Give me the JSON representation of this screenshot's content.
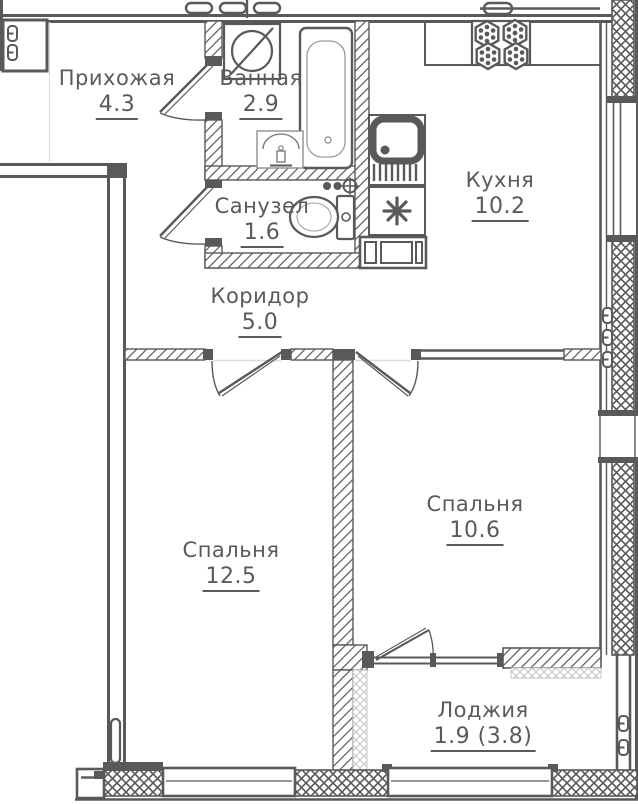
{
  "rooms": {
    "hallway": {
      "label": "Прихожая",
      "area": "4.3"
    },
    "bathroom": {
      "label": "Ванная",
      "area": "2.9"
    },
    "wc": {
      "label": "Санузел",
      "area": "1.6"
    },
    "kitchen": {
      "label": "Кухня",
      "area": "10.2"
    },
    "corridor": {
      "label": "Коридор",
      "area": "5.0"
    },
    "bedroom_main": {
      "label": "Спальня",
      "area": "12.5"
    },
    "bedroom_second": {
      "label": "Спальня",
      "area": "10.6"
    },
    "loggia": {
      "label": "Лоджия",
      "area": "1.9 (3.8)"
    }
  },
  "fixtures": [
    "washing-machine",
    "bathtub",
    "wash-basin",
    "toilet",
    "kitchen-sink",
    "stove-burners",
    "ventilation-shaft",
    "radiator"
  ],
  "colors": {
    "wall": "#58595b",
    "hatch_light": "#c6c6c6",
    "background": "#ffffff",
    "faint_line": "#dcdcdc"
  }
}
